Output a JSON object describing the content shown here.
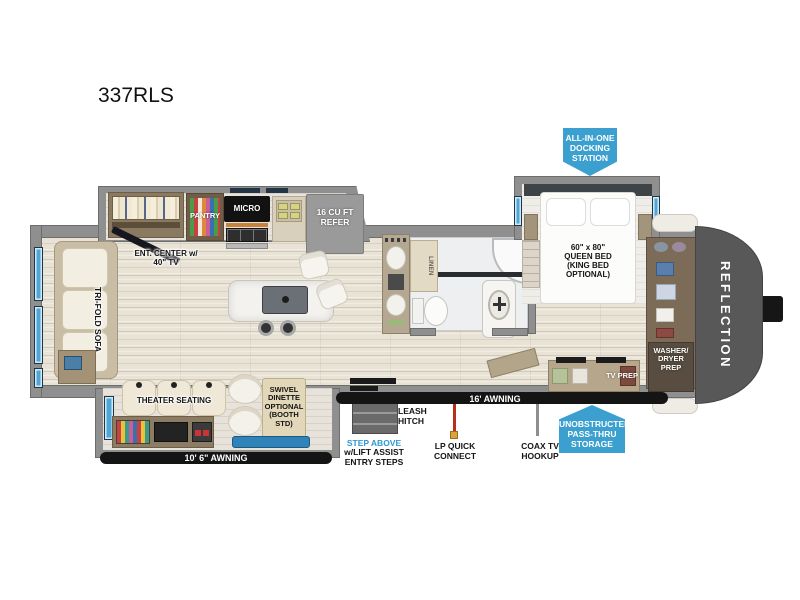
{
  "title": "337RLS",
  "callouts": {
    "docking": "ALL-IN-ONE\nDOCKING\nSTATION",
    "passthru": "UNOBSTRUCTED\nPASS-THRU\nSTORAGE"
  },
  "exterior": {
    "awning_left": "10' 6\" AWNING",
    "awning_right": "16' AWNING",
    "leash_hitch": "LEASH\nHITCH",
    "lp_connect": "LP QUICK\nCONNECT",
    "coax": "COAX TV\nHOOKUP",
    "step_above": "STEP ABOVE",
    "step_above_sub": "w/LIFT ASSIST\nENTRY STEPS",
    "brand": "REFLECTION"
  },
  "rooms": {
    "living": {
      "sofa": "TRI-FOLD SOFA",
      "ent_center": "ENT. CENTER w/\n40\" TV",
      "theater": "THEATER SEATING",
      "dinette": "SWIVEL\nDINETTE\nOPTIONAL\n(BOOTH STD)"
    },
    "kitchen": {
      "pantry": "PANTRY",
      "micro": "MICRO",
      "refer": "16 CU FT\nREFER"
    },
    "bath": {
      "linen": "LINEN"
    },
    "bedroom": {
      "bed": "60\" x 80\"\nQUEEN BED\n(KING BED\nOPTIONAL)",
      "washer_dryer": "WASHER/\nDRYER\nPREP",
      "tv_prep": "TV PREP"
    }
  },
  "colors": {
    "callout_blue": "#3ba0cf",
    "step_above_blue": "#2d9ad0",
    "wall_gray": "#8f8f8f",
    "cap_gray": "#585858",
    "window_blue": "#4ea6d8",
    "lp_red": "#b5301f"
  }
}
